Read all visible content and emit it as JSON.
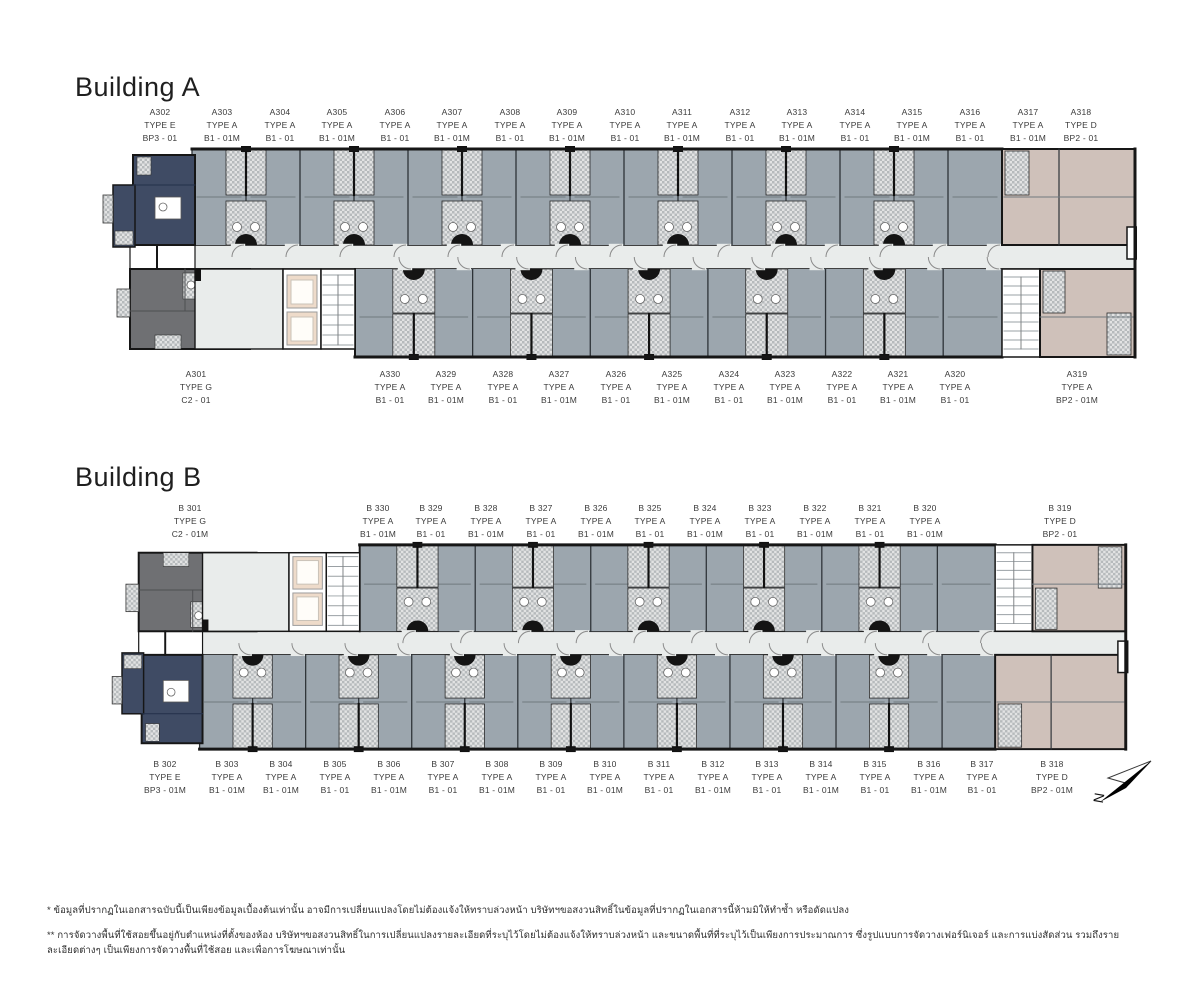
{
  "page": {
    "background": "#ffffff"
  },
  "colors": {
    "type_a_unit": "#9ca6ae",
    "type_e_unit": "#3f4b64",
    "type_g_unit": "#6f7073",
    "type_d_unit": "#cfc1ba",
    "corridor": "#e9eceb",
    "elevator": "#eedbca",
    "wall": "#161616",
    "hatch_light": "#e2e3e3",
    "hatch_dark": "#b6babc"
  },
  "north": {
    "label": "N"
  },
  "footnotes": {
    "line1": "* ข้อมูลที่ปรากฏในเอกสารฉบับนี้เป็นเพียงข้อมูลเบื้องต้นเท่านั้น อาจมีการเปลี่ยนแปลงโดยไม่ต้องแจ้งให้ทราบล่วงหน้า บริษัทฯขอสงวนสิทธิ์ในข้อมูลที่ปรากฏในเอกสารนี้ห้ามมิให้ทำซ้ำ หรือดัดแปลง",
    "line2": "** การจัดวางพื้นที่ใช้สอยขึ้นอยู่กับตำแหน่งที่ตั้งของห้อง บริษัทฯขอสงวนสิทธิ์ในการเปลี่ยนแปลงรายละเอียดที่ระบุไว้โดยไม่ต้องแจ้งให้ทราบล่วงหน้า และขนาดพื้นที่ที่ระบุไว้เป็นเพียงการประมาณการ ซึ่งรูปแบบการจัดวางเฟอร์นิเจอร์ และการแบ่งสัดส่วน รวมถึงรายละเอียดต่างๆ เป็นเพียงการจัดวางพื้นที่ใช้สอย และเพื่อการโฆษณาเท่านั้น"
  },
  "buildings": [
    {
      "title": "Building A",
      "top_units": [
        {
          "no": "A302",
          "type": "TYPE E",
          "plan": "BP3 - 01"
        },
        {
          "no": "A303",
          "type": "TYPE A",
          "plan": "B1 - 01M"
        },
        {
          "no": "A304",
          "type": "TYPE A",
          "plan": "B1 - 01"
        },
        {
          "no": "A305",
          "type": "TYPE A",
          "plan": "B1 - 01M"
        },
        {
          "no": "A306",
          "type": "TYPE A",
          "plan": "B1 - 01"
        },
        {
          "no": "A307",
          "type": "TYPE A",
          "plan": "B1 - 01M"
        },
        {
          "no": "A308",
          "type": "TYPE A",
          "plan": "B1 - 01"
        },
        {
          "no": "A309",
          "type": "TYPE A",
          "plan": "B1 - 01M"
        },
        {
          "no": "A310",
          "type": "TYPE A",
          "plan": "B1 - 01"
        },
        {
          "no": "A311",
          "type": "TYPE A",
          "plan": "B1 - 01M"
        },
        {
          "no": "A312",
          "type": "TYPE A",
          "plan": "B1 - 01"
        },
        {
          "no": "A313",
          "type": "TYPE A",
          "plan": "B1 - 01M"
        },
        {
          "no": "A314",
          "type": "TYPE A",
          "plan": "B1 - 01"
        },
        {
          "no": "A315",
          "type": "TYPE A",
          "plan": "B1 - 01M"
        },
        {
          "no": "A316",
          "type": "TYPE A",
          "plan": "B1 - 01"
        },
        {
          "no": "A317",
          "type": "TYPE A",
          "plan": "B1 - 01M"
        },
        {
          "no": "A318",
          "type": "TYPE D",
          "plan": "BP2 - 01"
        }
      ],
      "bottom_units": [
        {
          "no": "A301",
          "type": "TYPE G",
          "plan": "C2 - 01"
        },
        {
          "no": "A330",
          "type": "TYPE A",
          "plan": "B1 - 01"
        },
        {
          "no": "A329",
          "type": "TYPE A",
          "plan": "B1 - 01M"
        },
        {
          "no": "A328",
          "type": "TYPE A",
          "plan": "B1 - 01"
        },
        {
          "no": "A327",
          "type": "TYPE A",
          "plan": "B1 - 01M"
        },
        {
          "no": "A326",
          "type": "TYPE A",
          "plan": "B1 - 01"
        },
        {
          "no": "A325",
          "type": "TYPE A",
          "plan": "B1 - 01M"
        },
        {
          "no": "A324",
          "type": "TYPE A",
          "plan": "B1 - 01"
        },
        {
          "no": "A323",
          "type": "TYPE A",
          "plan": "B1 - 01M"
        },
        {
          "no": "A322",
          "type": "TYPE A",
          "plan": "B1 - 01"
        },
        {
          "no": "A321",
          "type": "TYPE A",
          "plan": "B1 - 01M"
        },
        {
          "no": "A320",
          "type": "TYPE A",
          "plan": "B1 - 01"
        },
        {
          "no": "A319",
          "type": "TYPE A",
          "plan": "BP2 - 01M"
        }
      ]
    },
    {
      "title": "Building B",
      "top_units": [
        {
          "no": "B 301",
          "type": "TYPE G",
          "plan": "C2 - 01M"
        },
        {
          "no": "B 330",
          "type": "TYPE A",
          "plan": "B1 - 01M"
        },
        {
          "no": "B 329",
          "type": "TYPE A",
          "plan": "B1 - 01"
        },
        {
          "no": "B 328",
          "type": "TYPE A",
          "plan": "B1 - 01M"
        },
        {
          "no": "B 327",
          "type": "TYPE A",
          "plan": "B1 - 01"
        },
        {
          "no": "B 326",
          "type": "TYPE A",
          "plan": "B1 - 01M"
        },
        {
          "no": "B 325",
          "type": "TYPE A",
          "plan": "B1 - 01"
        },
        {
          "no": "B 324",
          "type": "TYPE A",
          "plan": "B1 - 01M"
        },
        {
          "no": "B 323",
          "type": "TYPE A",
          "plan": "B1 - 01"
        },
        {
          "no": "B 322",
          "type": "TYPE A",
          "plan": "B1 - 01M"
        },
        {
          "no": "B 321",
          "type": "TYPE A",
          "plan": "B1 - 01"
        },
        {
          "no": "B 320",
          "type": "TYPE A",
          "plan": "B1 - 01M"
        },
        {
          "no": "B 319",
          "type": "TYPE D",
          "plan": "BP2 - 01"
        }
      ],
      "bottom_units": [
        {
          "no": "B 302",
          "type": "TYPE E",
          "plan": "BP3 - 01M"
        },
        {
          "no": "B 303",
          "type": "TYPE A",
          "plan": "B1 - 01M"
        },
        {
          "no": "B 304",
          "type": "TYPE A",
          "plan": "B1 - 01M"
        },
        {
          "no": "B 305",
          "type": "TYPE A",
          "plan": "B1 - 01"
        },
        {
          "no": "B 306",
          "type": "TYPE A",
          "plan": "B1 - 01M"
        },
        {
          "no": "B 307",
          "type": "TYPE A",
          "plan": "B1 - 01"
        },
        {
          "no": "B 308",
          "type": "TYPE A",
          "plan": "B1 - 01M"
        },
        {
          "no": "B 309",
          "type": "TYPE A",
          "plan": "B1 - 01"
        },
        {
          "no": "B 310",
          "type": "TYPE A",
          "plan": "B1 - 01M"
        },
        {
          "no": "B 311",
          "type": "TYPE A",
          "plan": "B1 - 01"
        },
        {
          "no": "B 312",
          "type": "TYPE A",
          "plan": "B1 - 01M"
        },
        {
          "no": "B 313",
          "type": "TYPE A",
          "plan": "B1 - 01"
        },
        {
          "no": "B 314",
          "type": "TYPE A",
          "plan": "B1 - 01M"
        },
        {
          "no": "B 315",
          "type": "TYPE A",
          "plan": "B1 - 01"
        },
        {
          "no": "B 316",
          "type": "TYPE A",
          "plan": "B1 - 01M"
        },
        {
          "no": "B 317",
          "type": "TYPE A",
          "plan": "B1 - 01"
        },
        {
          "no": "B 318",
          "type": "TYPE D",
          "plan": "BP2 - 01M"
        }
      ]
    }
  ]
}
